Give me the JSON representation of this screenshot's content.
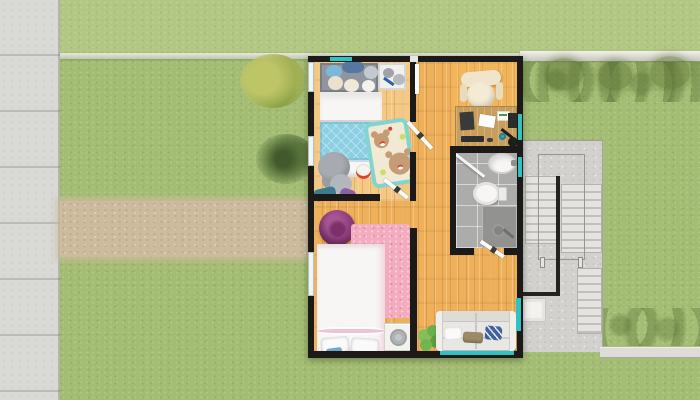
{
  "scene": {
    "type": "3d-rendered-floor-plan",
    "view": "top-down",
    "rooms": [
      {
        "id": "kids-bedroom",
        "furniture": [
          "single-bed-blue-blanket",
          "headboard-shelf-plush-toys",
          "toy-crate",
          "bear-play-rug",
          "plush-elephant",
          "plush-penguin",
          "toys"
        ]
      },
      {
        "id": "master-bedroom",
        "furniture": [
          "double-bed-white-pink",
          "pink-rug",
          "purple-pouf",
          "washing-machine",
          "slippers"
        ]
      },
      {
        "id": "home-office-nook",
        "furniture": [
          "wooden-desk",
          "office-chair",
          "desk-lamp",
          "papers",
          "keyboard",
          "mug"
        ]
      },
      {
        "id": "bathroom",
        "furniture": [
          "sink",
          "toilet",
          "shower-head",
          "glass-partition"
        ]
      },
      {
        "id": "hallway-living-area",
        "furniture": [
          "sofa",
          "throw-pillows",
          "potted-plant",
          "interior-doors"
        ]
      }
    ],
    "environment": [
      "grass-lawn",
      "concrete-sidewalk-left",
      "dirt-path",
      "perimeter-fence-line",
      "hedge-shrubs",
      "yellow-bush",
      "dark-palm-plant",
      "tree-canopies",
      "outdoor-concrete-staircase",
      "stair-railings",
      "utility-panel",
      "sidewalk-bottom-right"
    ]
  },
  "colors": {
    "grass": "#a4bd74",
    "dirtPath": "#cdbb9e",
    "sidewalk": "#dddcd8",
    "concreteWall": "#d9d9d6",
    "stairConcrete": "#d2d1ce",
    "treadLight": "#e4e3e0",
    "treadDark": "#c0bfbc",
    "wall": "#1b1a18",
    "woodHall": "#eeb05a",
    "woodKids": "#f4c985",
    "deskWood": "#c79e5d",
    "tile": "#acacaa",
    "tileDark": "#929290",
    "fixtureWhite": "#f7f6f4",
    "blanketBlue": "#8ccfe3",
    "rugCream": "#f2e9d5",
    "rugTealBorder": "#82d5cf",
    "bearBrown": "#c49d77",
    "plushGray": "#a7abb1",
    "headboardGray": "#8f969d",
    "rugPink": "#f2abbf",
    "bedPinkTrim": "#efc2d6",
    "pouf": "#8c3c7b",
    "sofa": "#e9e7e4",
    "pillowTaupe": "#9c8968",
    "pillowBlue": "#40609d",
    "plantGreen": "#6dae4c",
    "chairCream": "#f0e5ca",
    "windowTeal": "#2fc2c2",
    "doorWhite": "#fbfbf9",
    "applianceWhite": "#f3f2ef"
  }
}
